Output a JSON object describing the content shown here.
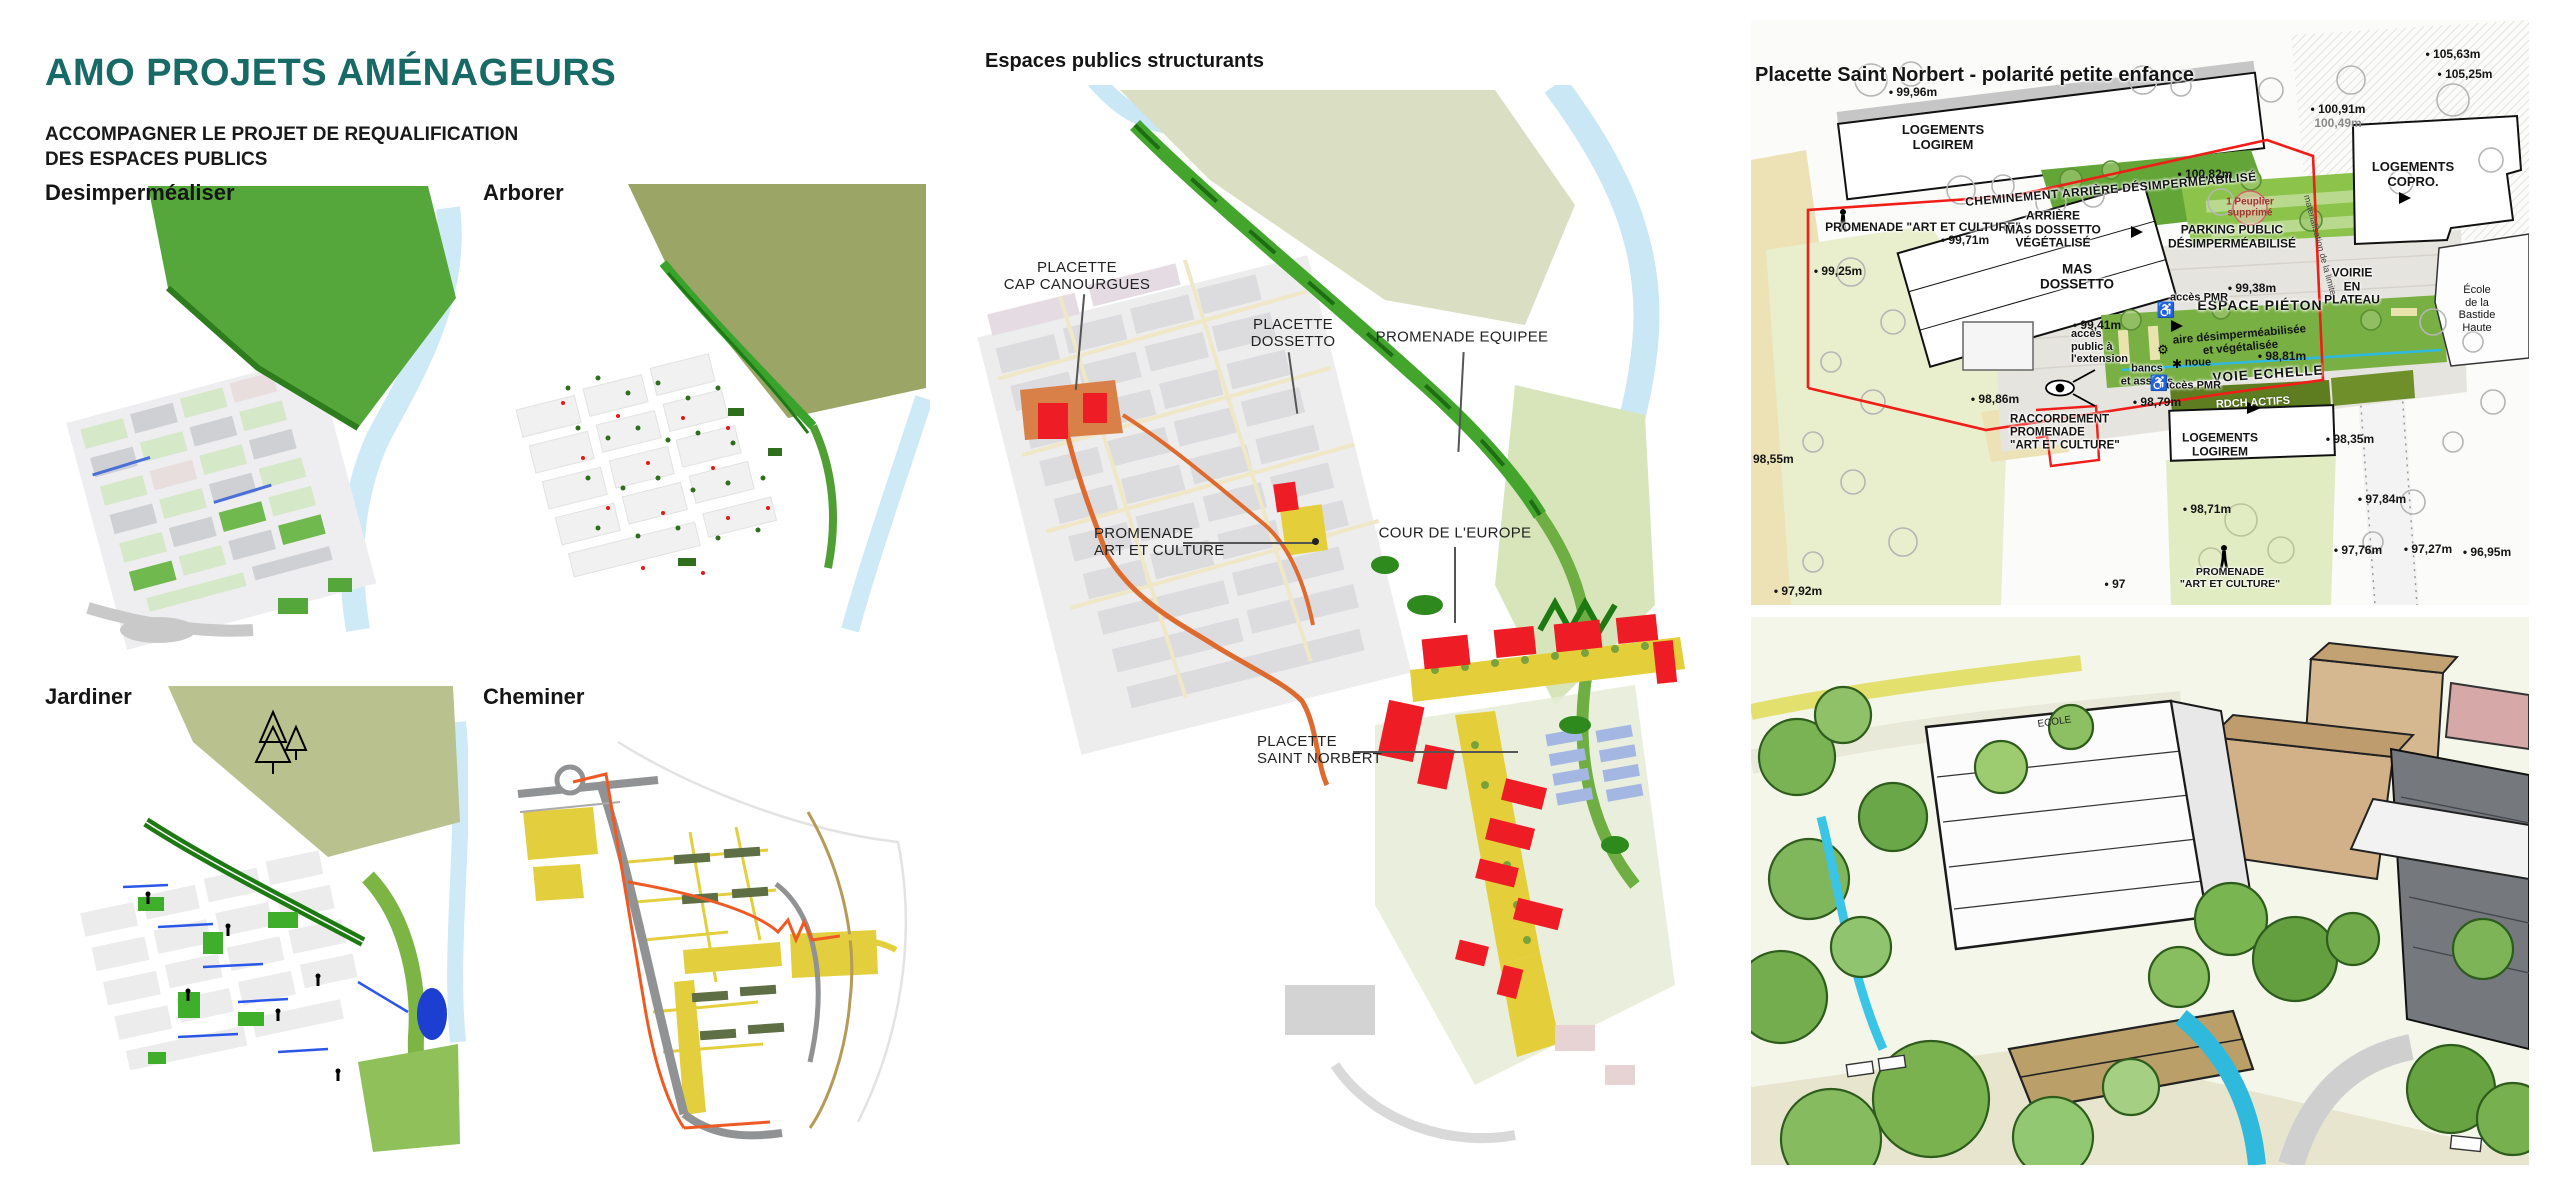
{
  "palette": {
    "accent_teal": "#176a66",
    "map_green": "#53a534",
    "corridor_dark_green": "#1d7a12",
    "olive_hill": "#9aa566",
    "pale_olive_hill": "#dadec2",
    "river_blue": "#c9e7f4",
    "promenade_yellow": "#e4cf3a",
    "path_orange": "#dd6a2e",
    "building_red": "#ed1c24",
    "boundary_red": "#f01e18",
    "lawn_green": "#e9efcd",
    "planting_green": "#79b043",
    "noue_cyan": "#2fb9dd"
  },
  "header": {
    "title": "AMO PROJETS AMÉNAGEURS",
    "subtitle": "ACCOMPAGNER LE PROJET DE REQUALIFICATION\nDES ESPACES PUBLICS"
  },
  "mini_maps": {
    "items": [
      {
        "label": "Desimperméaliser"
      },
      {
        "label": "Arborer"
      },
      {
        "label": "Jardiner"
      },
      {
        "label": "Cheminer"
      }
    ]
  },
  "central_map": {
    "title": "Espaces publics structurants",
    "annotations": {
      "cap_canourgues": "PLACETTE\nCAP CANOURGUES",
      "dossetto": "PLACETTE\nDOSSETTO",
      "promenade_equipee": "PROMENADE EQUIPEE",
      "promenade_art_culture": "PROMENADE\nART ET CULTURE",
      "cour_europe": "COUR DE L'EUROPE",
      "saint_norbert": "PLACETTE\nSAINT NORBERT"
    }
  },
  "detail_plan": {
    "title": "Placette Saint Norbert - polarité petite enfance",
    "buildings": {
      "logirem_top": "LOGEMENTS\nLOGIREM",
      "copro": "LOGEMENTS\nCOPRO.",
      "mas_dossetto": "MAS\nDOSSETTO",
      "logirem_bottom": "LOGEMENTS\nLOGIREM",
      "ecole": "École\nde la Bastide Haute"
    },
    "areas": {
      "cheminement": "CHEMINEMENT ARRIÈRE DÉSIMPERMÉABILISÉ",
      "promenade_top": "PROMENADE \"ART ET CULTURE\"",
      "arriere_mas": "ARRIÈRE\nMAS DOSSETTO\nVÉGÉTALISÉ",
      "parking": "PARKING PUBLIC\nDÉSIMPERMÉABILISÉ",
      "peuplier": "1 Peuplier\nsupprimé",
      "espace_pieton": "ESPACE PIÉTON",
      "voirie_plateau": "VOIRIE\nEN\nPLATEAU",
      "acces_pmr_1": "accès PMR",
      "acces_pmr_2": "accès PMR",
      "acces_public": "accès\npublic à\nl'extension",
      "aire": "aire désimperméabilisée\net végétalisée",
      "noue": "noue",
      "bancs": "bancs\net assises",
      "voie_echelle": "VOIE ECHELLE",
      "rdch": "RDCH ACTIFS",
      "raccordement": "RACCORDEMENT\nPROMENADE\n\"ART ET CULTURE\"",
      "promenade_bottom": "PROMENADE\n\"ART ET CULTURE\"",
      "limite": "matérialisation de la limite"
    },
    "elevations": {
      "e105_63": "• 105,63m",
      "e105_25": "• 105,25m",
      "e100_91": "• 100,91m",
      "e100_49": "100,49m",
      "e100_82": "• 100,82m",
      "e99_96": "• 99,96m",
      "e99_71": "• 99,71m",
      "e99_25": "• 99,25m",
      "e99_41": "• 99,41m",
      "e99_38": "• 99,38m",
      "e98_86": "• 98,86m",
      "e98_81": "• 98,81m",
      "e98_79": "• 98,79m",
      "e98_55": "98,55m",
      "e98_35": "• 98,35m",
      "e98_71": "• 98,71m",
      "e97_92": "• 97,92m",
      "e97_84": "• 97,84m",
      "e97_76": "• 97,76m",
      "e97_27": "• 97,27m",
      "e96_95": "• 96,95m",
      "e97": "• 97"
    },
    "icons": {
      "wheelchair": "♿",
      "gear": "⚙",
      "flower": "✱"
    }
  },
  "perspective": {
    "ecole_label": "ECOLE"
  }
}
